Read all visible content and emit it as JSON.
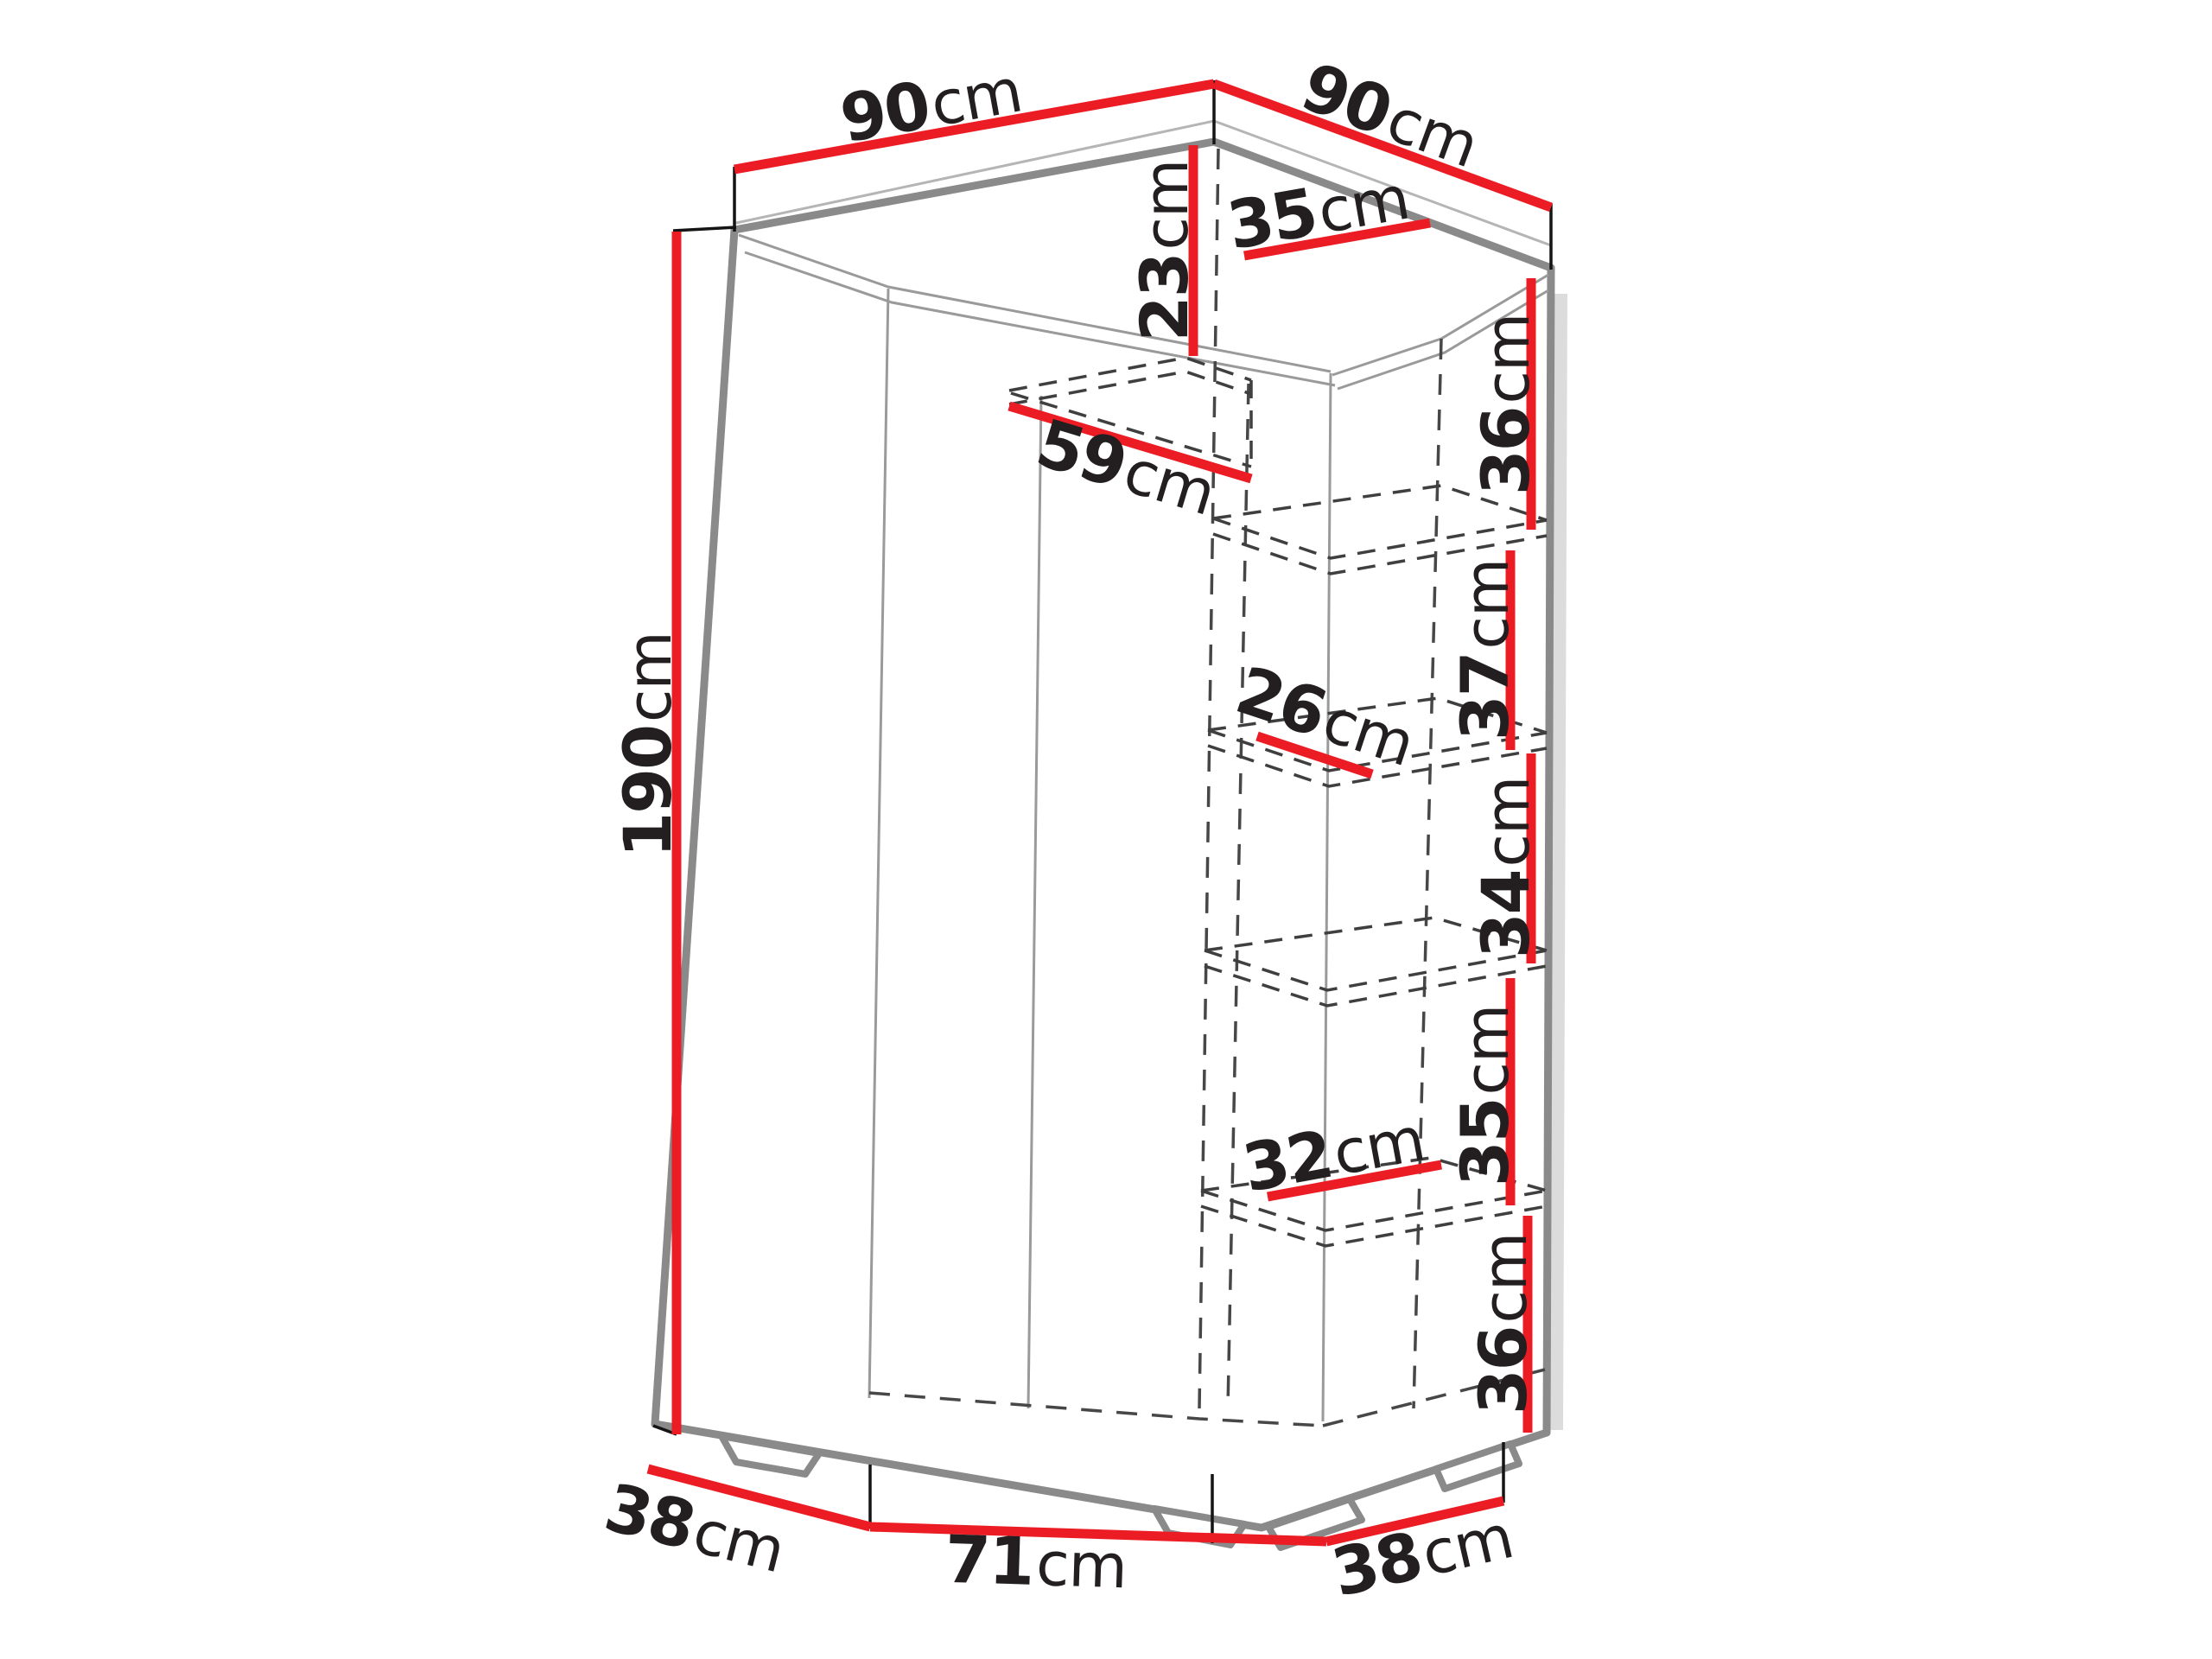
{
  "diagram": {
    "subject": "corner-wardrobe-dimension-diagram",
    "colors": {
      "accent": "#ec1c24",
      "edges": "#8a8a8a",
      "text": "#231f20"
    }
  },
  "dims": {
    "width_left": {
      "value": "90",
      "unit": "cm"
    },
    "width_right": {
      "value": "90",
      "unit": "cm"
    },
    "top_compartment_height": {
      "value": "23",
      "unit": "cm"
    },
    "top_shelf_depth_right": {
      "value": "35",
      "unit": "cm"
    },
    "top_shelf_depth_left": {
      "value": "59",
      "unit": "cm"
    },
    "shelf_gap_1": {
      "value": "36",
      "unit": "cm"
    },
    "shelf_gap_2": {
      "value": "37",
      "unit": "cm"
    },
    "middle_shelf_depth": {
      "value": "26",
      "unit": "cm"
    },
    "shelf_gap_3": {
      "value": "34",
      "unit": "cm"
    },
    "shelf_gap_4": {
      "value": "35",
      "unit": "cm"
    },
    "lower_shelf_depth": {
      "value": "32",
      "unit": "cm"
    },
    "shelf_gap_5": {
      "value": "36",
      "unit": "cm"
    },
    "total_height": {
      "value": "190",
      "unit": "cm"
    },
    "base_depth_left": {
      "value": "38",
      "unit": "cm"
    },
    "base_width_front": {
      "value": "71",
      "unit": "cm"
    },
    "base_depth_right": {
      "value": "38",
      "unit": "cm"
    }
  }
}
